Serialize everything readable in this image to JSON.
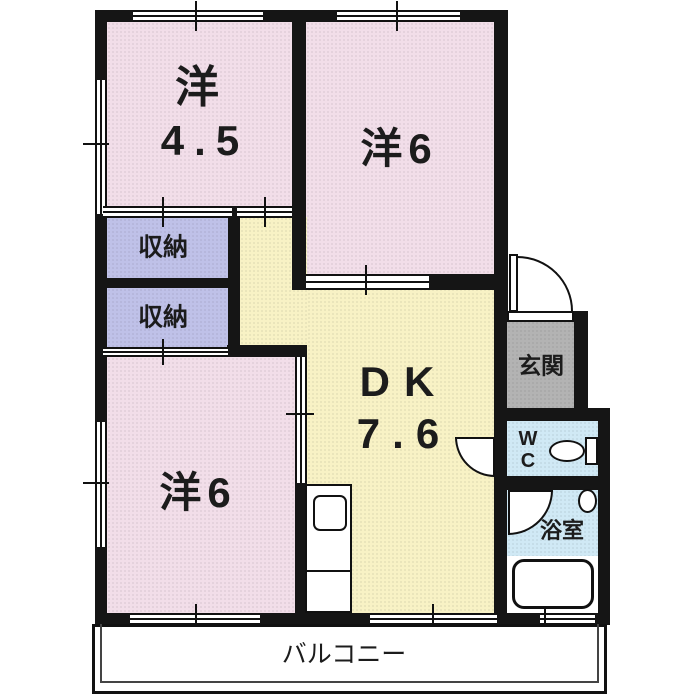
{
  "colors": {
    "wall": "#151515",
    "room_pink": "#f2dee9",
    "dk_yellow": "#f8f2c5",
    "closet_lavender": "#bfc1e8",
    "entrance_gray": "#b3b3b3",
    "wet_area_blue": "#d0e9f5",
    "text": "#1c1c1c"
  },
  "rooms": {
    "western_4_5": {
      "name": "洋",
      "size": "4.5"
    },
    "western_6_upper": {
      "name": "洋6"
    },
    "western_6_lower": {
      "name": "洋6"
    },
    "dining_kitchen": {
      "name": "DK",
      "size": "7.6"
    },
    "closet_upper": {
      "name": "収納"
    },
    "closet_lower": {
      "name": "収納"
    },
    "entrance": {
      "name": "玄関"
    },
    "wc": {
      "line1": "W",
      "line2": "C"
    },
    "bathroom": {
      "name": "浴室"
    },
    "balcony": {
      "name": "バルコニー"
    }
  },
  "fixtures": {
    "toilet": "toilet",
    "wash_basin": "wash-basin",
    "bathtub": "bathtub",
    "kitchen_counter": "kitchen-counter",
    "kitchen_sink": "kitchen-sink"
  }
}
